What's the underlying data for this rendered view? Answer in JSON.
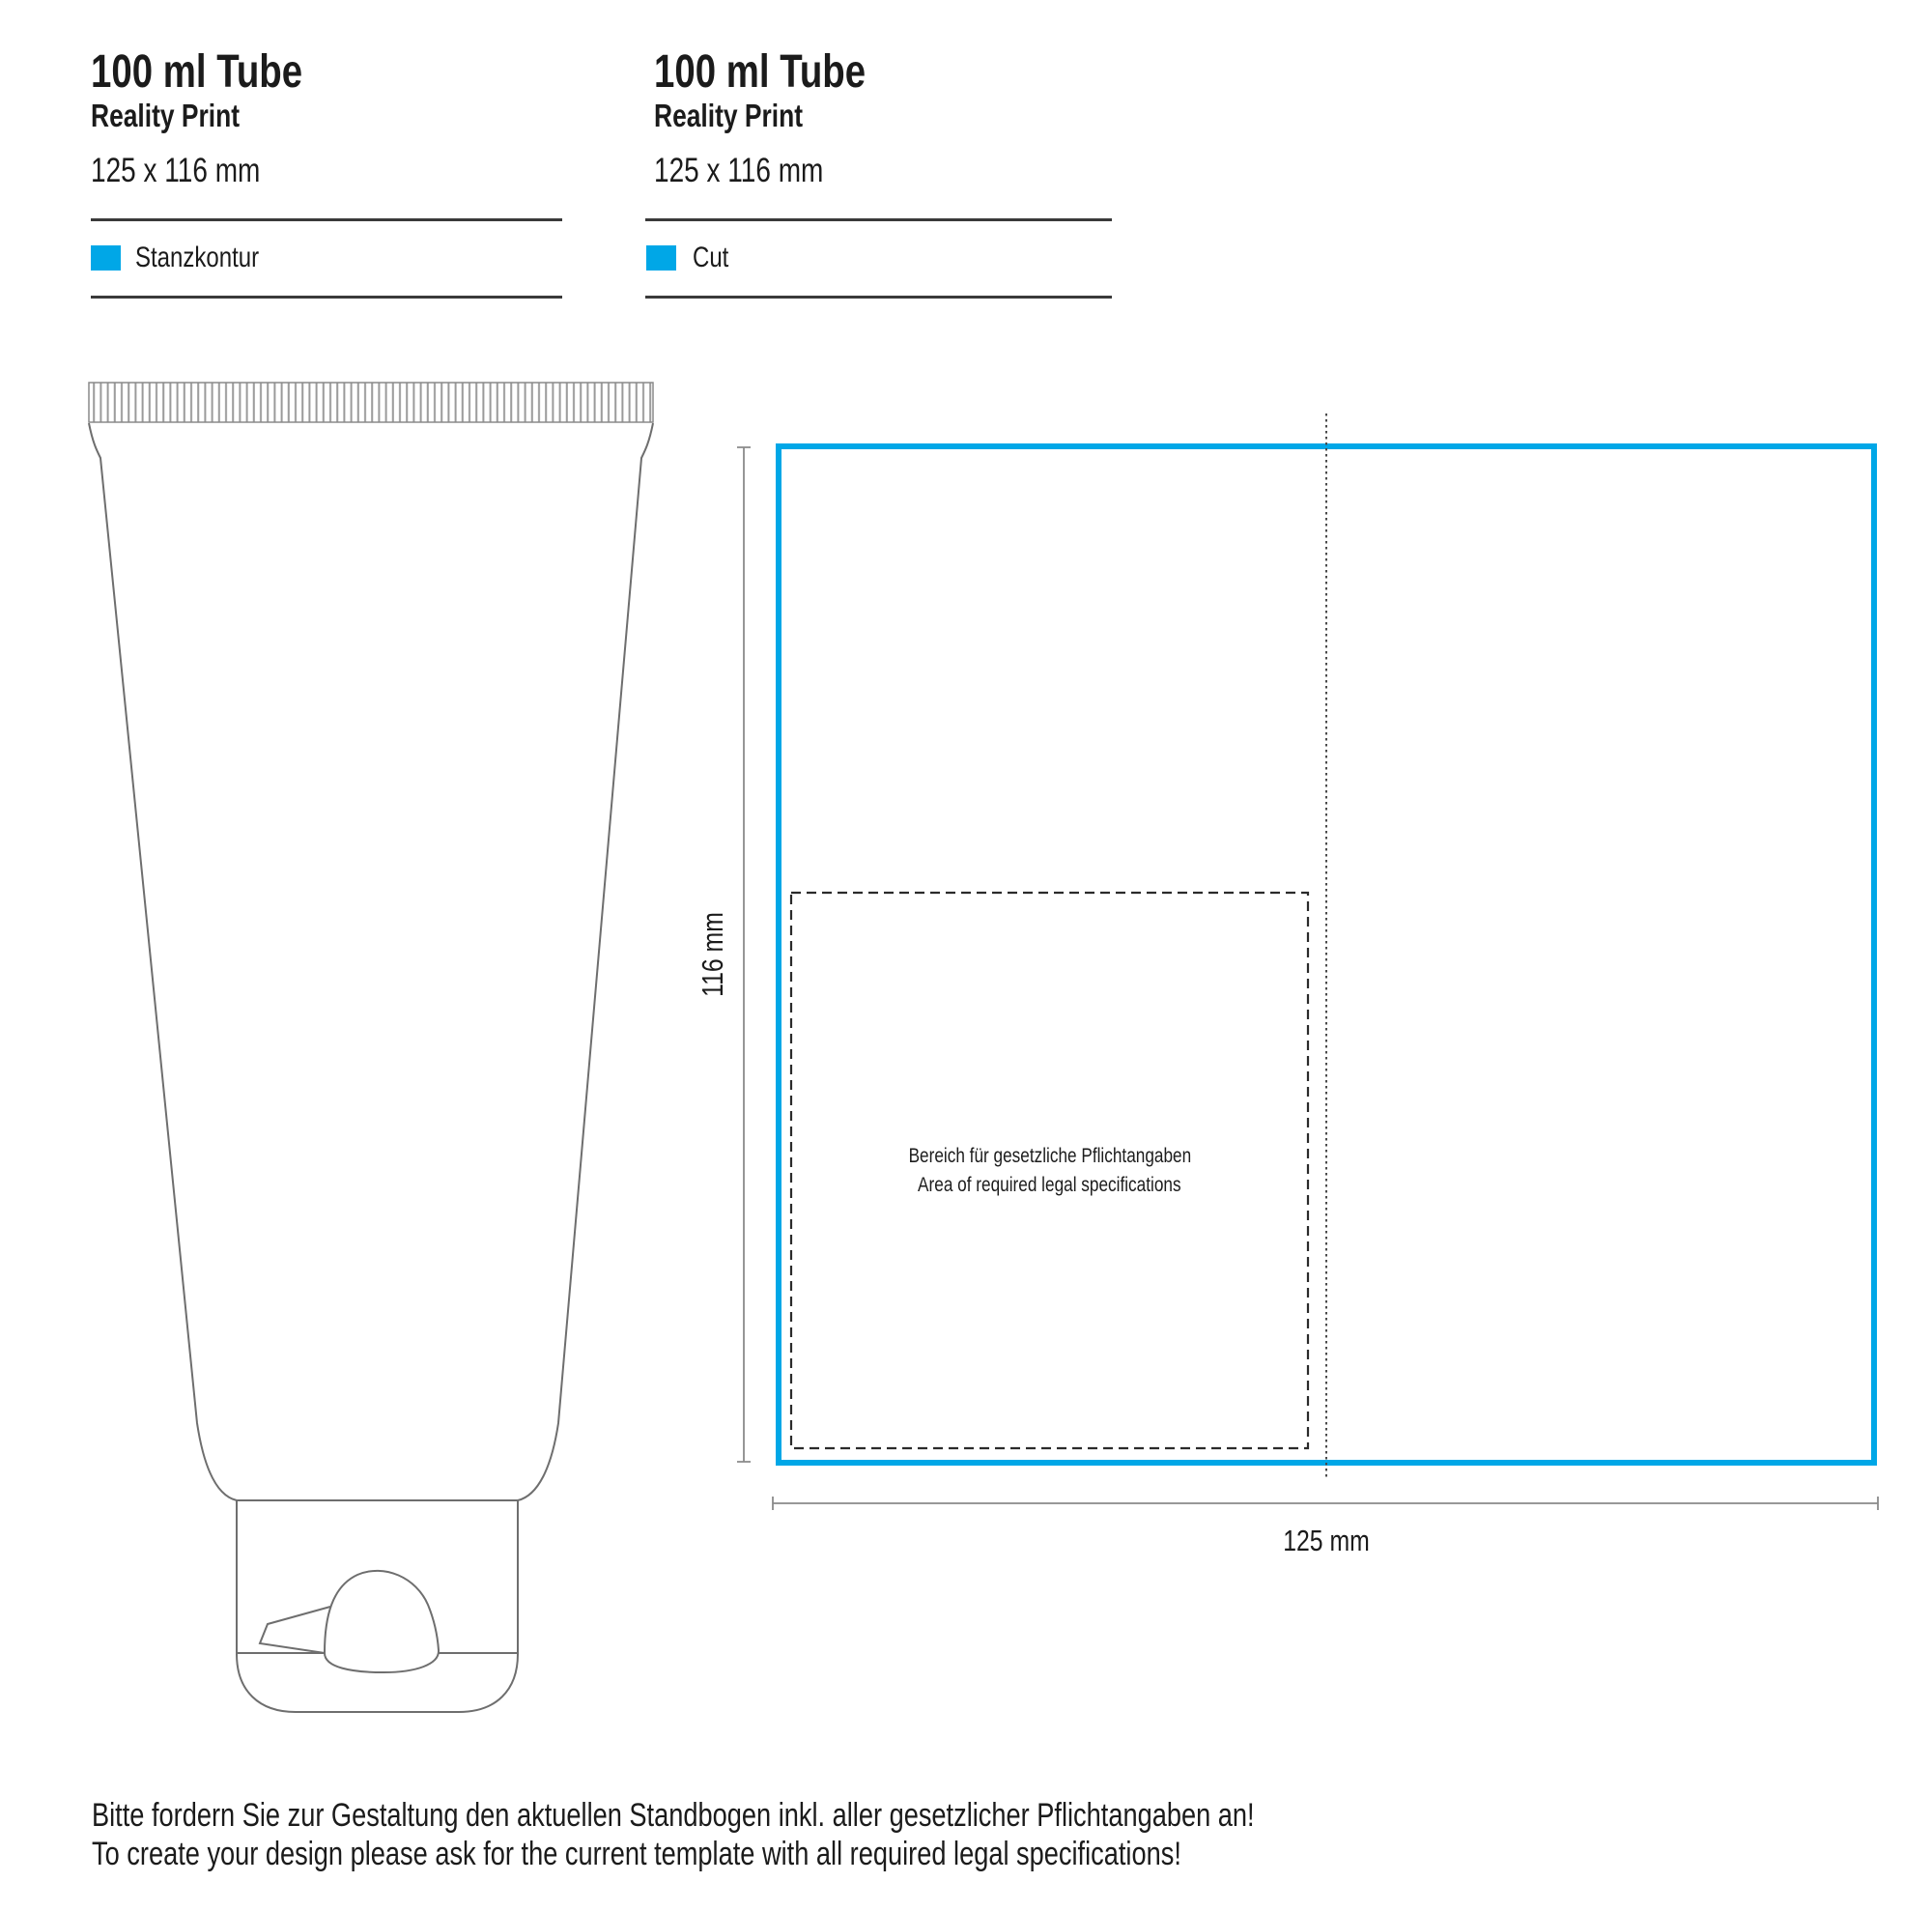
{
  "colors": {
    "accent_cyan": "#00A7E7",
    "rule_gray": "#3a3a3a",
    "outline_gray": "#6e6e6e",
    "dimension_gray": "#8a8a8a"
  },
  "headers": [
    {
      "title": "100 ml Tube",
      "subtitle": "Reality Print",
      "dimensions": "125 x 116 mm",
      "legend_label": "Stanzkontur"
    },
    {
      "title": "100 ml Tube",
      "subtitle": "Reality Print",
      "dimensions": "125 x 116 mm",
      "legend_label": "Cut"
    }
  ],
  "diagram": {
    "width_label": "125 mm",
    "height_label": "116 mm",
    "legal_area_line1": "Bereich für gesetzliche Pflichtangaben",
    "legal_area_line2": "Area of required legal specifications"
  },
  "footer": {
    "line1": "Bitte fordern Sie zur Gestaltung den aktuellen Standbogen inkl. aller gesetzlicher Pflichtangaben an!",
    "line2": "To create your design please ask for the current template with all required legal specifications!"
  }
}
